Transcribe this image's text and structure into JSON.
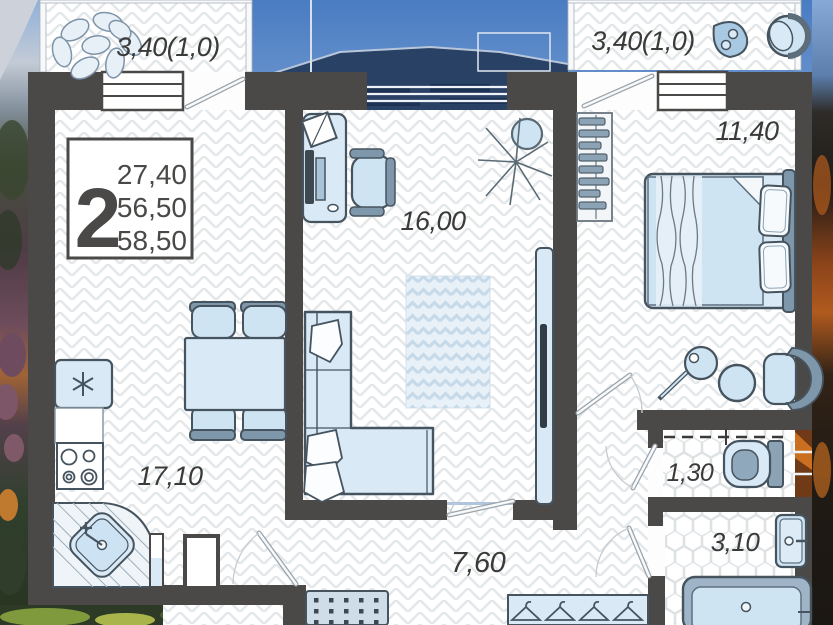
{
  "plan": {
    "labels": {
      "balcony_left": "3,40(1,0)",
      "balcony_right": "3,40(1,0)",
      "living_room": "16,00",
      "bedroom": "11,40",
      "kitchen": "17,10",
      "hallway": "7,60",
      "wc": "1,30",
      "bathroom": "3,10"
    },
    "info_box": {
      "room_count": "2",
      "living_area": "27,40",
      "apartment_area": "56,50",
      "total_area": "58,50"
    },
    "colors": {
      "wall": "#4a4947",
      "furniture_fill": "#d9e9f6",
      "furniture_stroke": "#46545f",
      "accent": "#8ba3b5",
      "label_text": "#3a3a38"
    }
  }
}
